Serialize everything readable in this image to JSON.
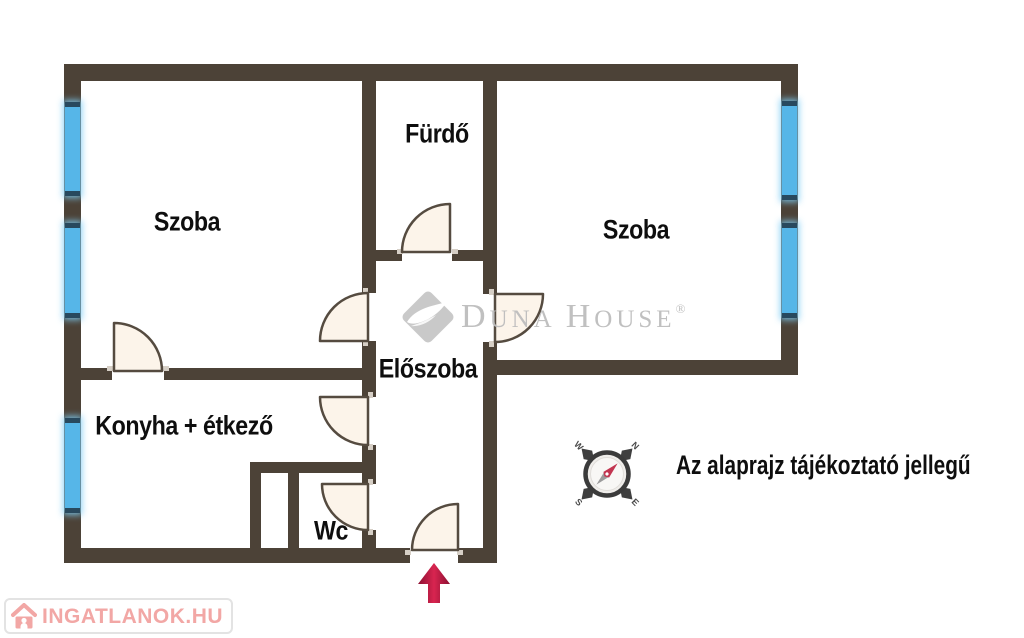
{
  "rooms": [
    {
      "name": "szoba-left",
      "label": "Szoba"
    },
    {
      "name": "furdo",
      "label": "Fürdő"
    },
    {
      "name": "szoba-right",
      "label": "Szoba"
    },
    {
      "name": "eloszoba",
      "label": "Előszoba"
    },
    {
      "name": "konyha",
      "label": "Konyha + étkező"
    },
    {
      "name": "wc",
      "label": "Wc"
    }
  ],
  "disclaimer": "Az alaprajz tájékoztató jellegű",
  "watermark": {
    "part1": "D",
    "part2": "UNA",
    "part3": "H",
    "part4": "OUSE",
    "registered": "®"
  },
  "compass": {
    "n": "N",
    "e": "E",
    "s": "S",
    "w": "W"
  },
  "footer_logo": {
    "text": "INGATLANOK.HU"
  },
  "colors": {
    "wall": "#4c4237",
    "window": "#56b6e8",
    "window_cap": "#28495e",
    "door_fill": "#fcf4ea",
    "door_stroke": "#554b40",
    "entrance_arrow": "#c01d44",
    "watermark_gray": "#bdbdbd",
    "logo_pink": "#f2a7a5"
  }
}
